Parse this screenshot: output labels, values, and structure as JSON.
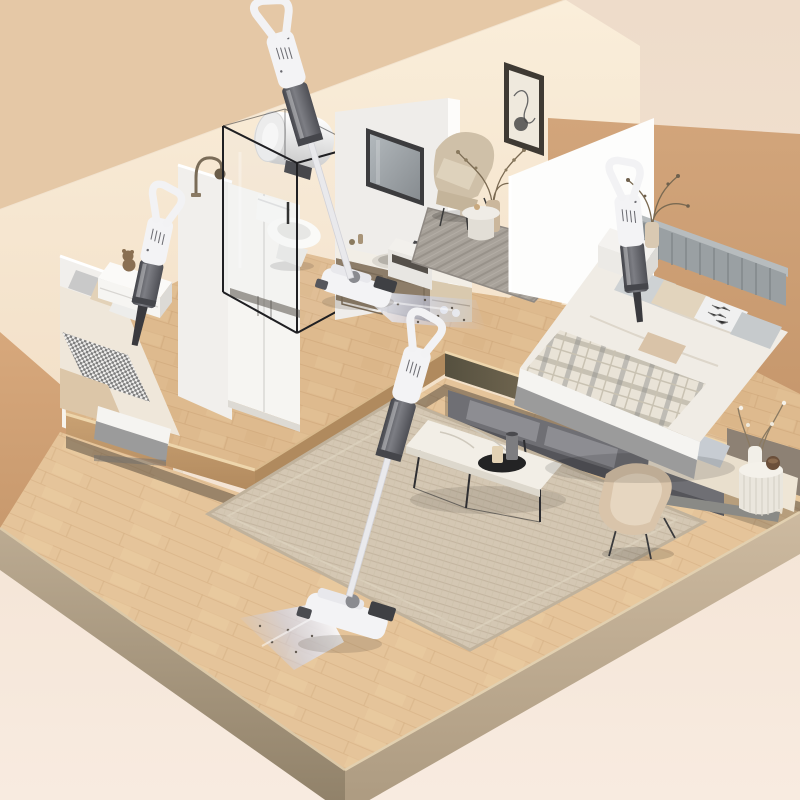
{
  "scene": {
    "style": "isometric dollhouse cutaway 3D render",
    "subject": "cordless stick and handheld vacuum cleaners cleaning a two-story home",
    "floors": 2,
    "vacuum_count": 4
  },
  "colors": {
    "bg_top": "#eedcca",
    "bg_bottom": "#f8ebe0",
    "ceiling": "#e5c8a6",
    "wall_cream": "#f9ecd9",
    "camel_right": "#cd9f74",
    "camel_left": "#d3a478",
    "white_wall": "#f1efec",
    "bright_wall": "#fdfdfc",
    "wood": "#deba8e",
    "wood_lower": "#e5c49a",
    "wood_face": "#c59d6f",
    "slab_lip": "#eed6ac",
    "taupe_wall": "#8d8174",
    "rug_lower": "#d4c7b3",
    "rug_nook": "#a8a29a",
    "sofa_cream": "#e9dfcd",
    "sofa_gray": "#6f6f74",
    "marble": "#f2eee6",
    "metal_dark": "#2e2e31",
    "vacuum_white": "#f3f3f5",
    "vacuum_cup": "#55565c",
    "glow_blue": "#bfcdf4",
    "bed_base_gray": "#9b9b9b",
    "mattress_white": "#f5f4f1",
    "blanket_beige": "#dcc6a8",
    "headboard_gray": "#9aa0a3",
    "toilet_white": "#f7f7f5",
    "heater_white": "#f4f4f4",
    "chair_beige": "#d9c4aa",
    "frame_dark": "#3f3a33"
  },
  "rooms": [
    {
      "name": "left-bedroom",
      "furniture": [
        "double-bed",
        "houndstooth-blanket",
        "pillows",
        "white-nightstand",
        "teddy-bear",
        "books"
      ]
    },
    {
      "name": "bathroom",
      "furniture": [
        "glass-shower-enclosure",
        "toilet",
        "tall-storage-cabinet",
        "vanity-with-sink",
        "mirror",
        "wall-water-heater",
        "gooseneck-faucet"
      ]
    },
    {
      "name": "reading-nook",
      "furniture": [
        "linen-armchair",
        "floor-plant",
        "round-side-table",
        "chevron-rug",
        "abstract-wall-art",
        "low-cabinet"
      ]
    },
    {
      "name": "right-bedroom",
      "furniture": [
        "double-bed",
        "slatted-headboard",
        "plaid-blanket",
        "pillows",
        "nightstand",
        "vase-with-branches"
      ]
    },
    {
      "name": "living-room-lower-floor",
      "furniture": [
        "woven-area-rug",
        "marble-coffee-table",
        "decor-vases",
        "cream-sofa",
        "gray-sofa",
        "shell-armchair",
        "fluted-side-table",
        "decor-plant"
      ]
    }
  ],
  "vacuums": [
    {
      "id": 1,
      "type": "handheld",
      "location": "over left bedroom bed",
      "state": "nozzle down"
    },
    {
      "id": 2,
      "type": "stick",
      "location": "upper floor hallway by bathroom",
      "state": "cleaning, suction glow on"
    },
    {
      "id": 3,
      "type": "handheld",
      "location": "over right bedroom bed",
      "state": "nozzle down"
    },
    {
      "id": 4,
      "type": "stick",
      "location": "lower floor living room",
      "state": "cleaning, suction glow on"
    }
  ]
}
